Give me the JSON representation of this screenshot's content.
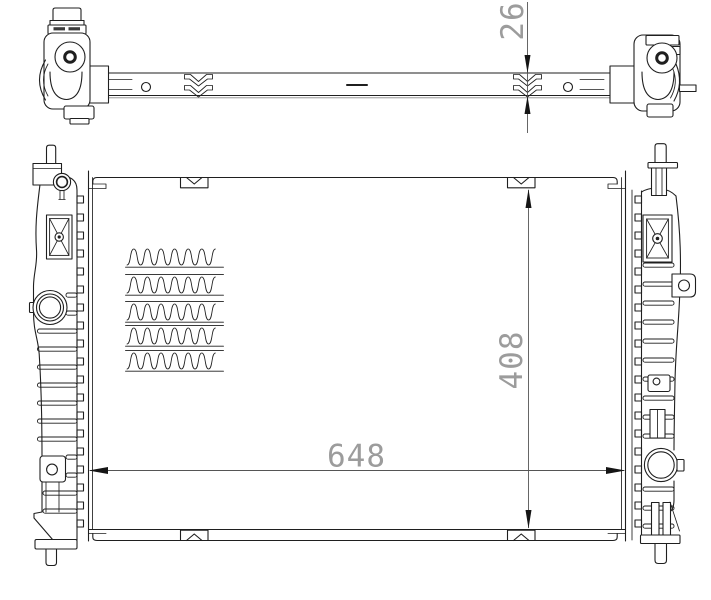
{
  "colors": {
    "background": "#ffffff",
    "line": "#1f1f1f",
    "dim_line": "#555555",
    "dim_text": "#9c9c9c"
  },
  "dimensions": {
    "core_thickness": {
      "value": "26",
      "orientation": "vertical-rotated"
    },
    "core_width": {
      "value": "648",
      "orientation": "horizontal"
    },
    "core_height": {
      "value": "408",
      "orientation": "vertical-rotated"
    }
  },
  "fins": {
    "x": 127,
    "width": 95,
    "wave_height": 16,
    "period": 13.6,
    "rows": [
      249,
      277,
      304,
      328,
      353
    ]
  }
}
